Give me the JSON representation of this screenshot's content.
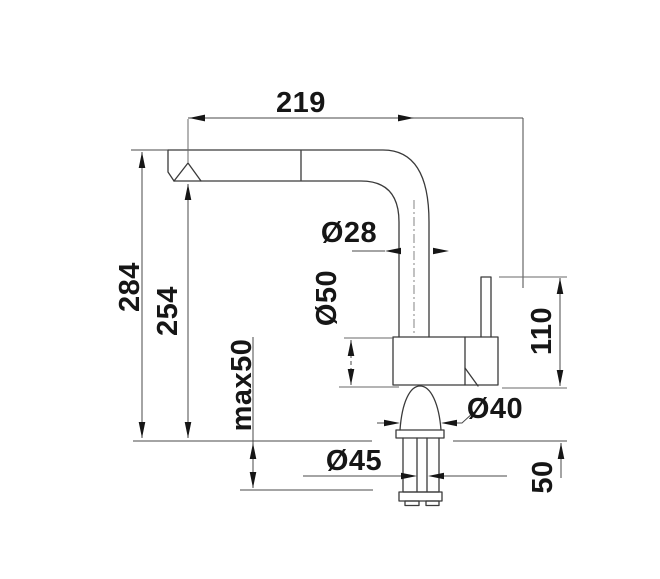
{
  "drawing": {
    "colors": {
      "line": "#3a3a3a",
      "dimension_line": "#4a4a4a",
      "text": "#161616",
      "background": "#ffffff"
    },
    "dimensions": {
      "spout_reach": "219",
      "total_height": "284",
      "spout_outlet_height": "254",
      "max_mounting_thickness": "max50",
      "spout_pipe_diameter": "Ø28",
      "body_diameter": "Ø50",
      "base_diameter": "Ø40",
      "tailpiece_diameter": "Ø45",
      "handle_top_height": "110",
      "shank_length": "50"
    }
  }
}
